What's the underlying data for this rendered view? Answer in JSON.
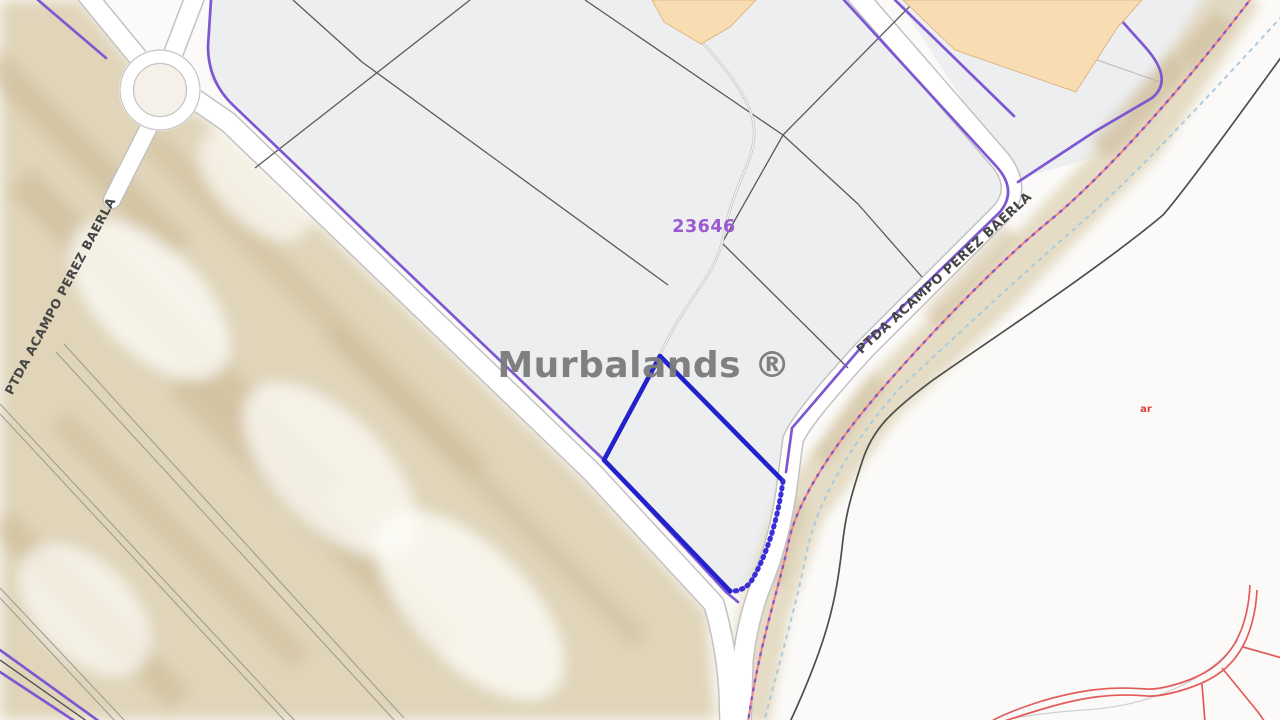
{
  "map": {
    "watermark": "Murbalands ®",
    "parcel_number": "23646",
    "street_label_left": "PTDA ACAMPO PEREZ BAERLA",
    "street_label_right": "PTDA ACAMPO PEREZ BAERLA",
    "small_red_label": "ar",
    "colors": {
      "background": "#fbfaf8",
      "parcel_fill": "#eceef0",
      "parcel_line": "#5a5a5a",
      "boundary_purple": "#7e57d2",
      "selected_parcel_blue": "#2222cc",
      "building_orange": "#f8dcb2",
      "road_casing": "#c2c2c2",
      "beige_texture": "#ddd0b2",
      "pink_boundary": "#ef8b8b",
      "dot_purple": "#8a56c8",
      "stream_blue": "#a9cbdf",
      "dark_boundary": "#4d4d4d",
      "red_lines": "#e25c5c",
      "label_gray": "#454545",
      "parcel_number_color": "#9b59d0",
      "watermark_color": "#7b7b7b",
      "red_label": "#e03c3c"
    }
  }
}
